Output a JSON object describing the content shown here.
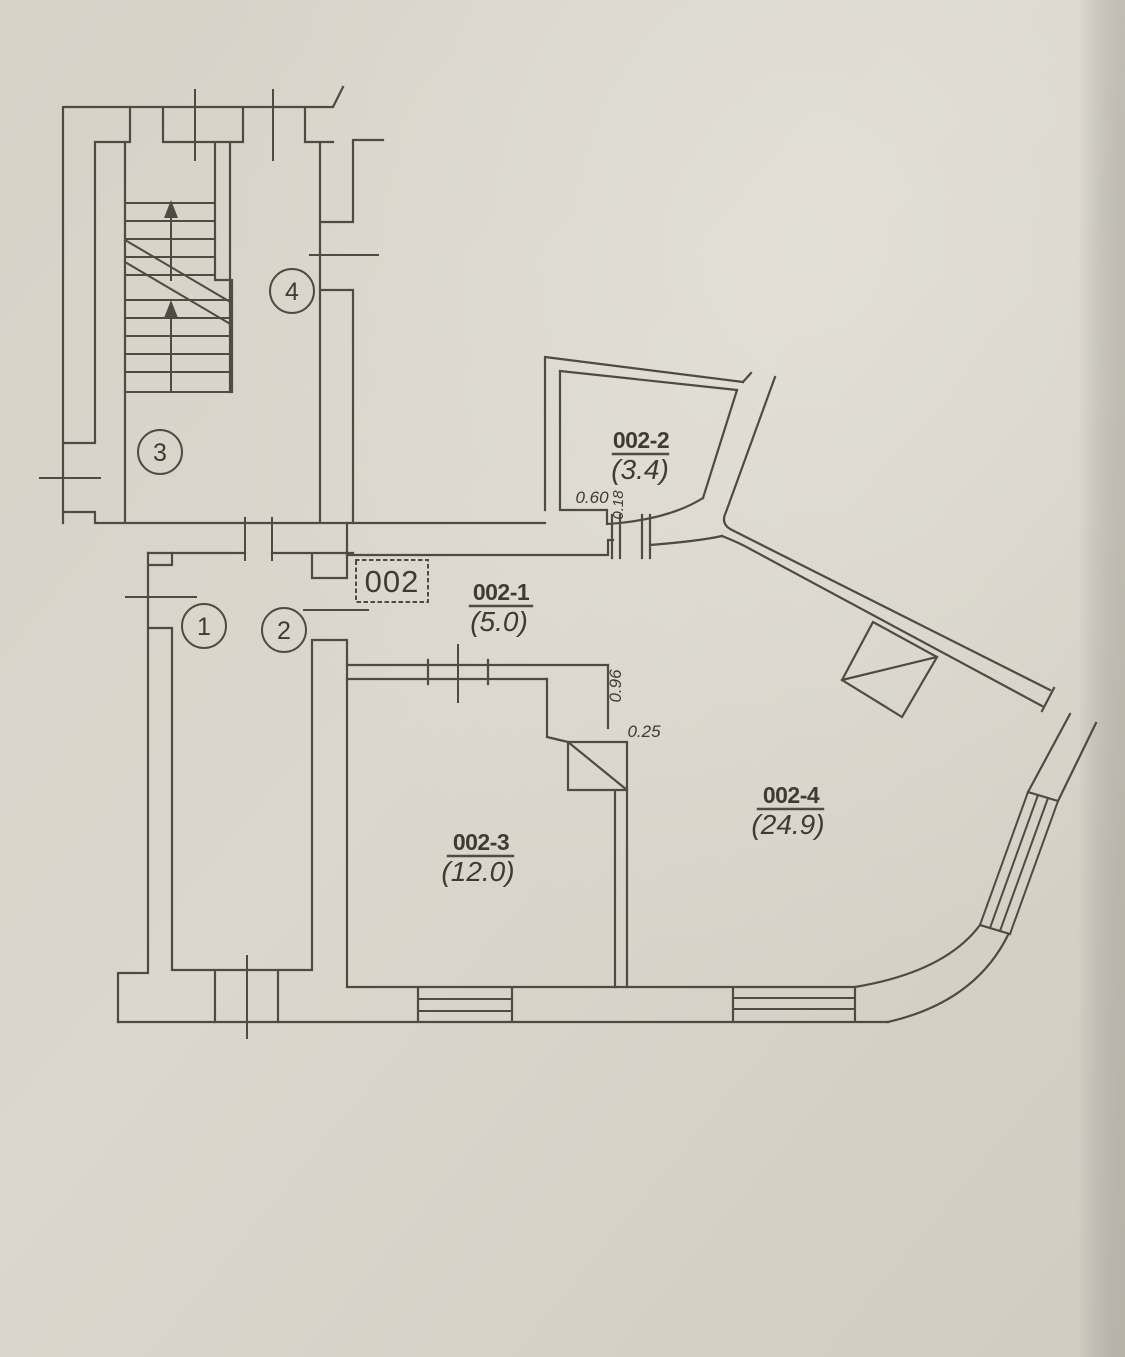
{
  "plan": {
    "unit_label": "002",
    "rooms": [
      {
        "id": "002-1",
        "area": "(5.0)"
      },
      {
        "id": "002-2",
        "area": "(3.4)"
      },
      {
        "id": "002-3",
        "area": "(12.0)"
      },
      {
        "id": "002-4",
        "area": "(24.9)"
      }
    ],
    "position_markers": [
      "1",
      "2",
      "3",
      "4"
    ],
    "dimensions": {
      "d060": "0.60",
      "d018": "0.18",
      "d096": "0.96",
      "d025": "0.25"
    },
    "colors": {
      "paper": "#d7d3c9",
      "ink": "#4f4a42"
    }
  }
}
